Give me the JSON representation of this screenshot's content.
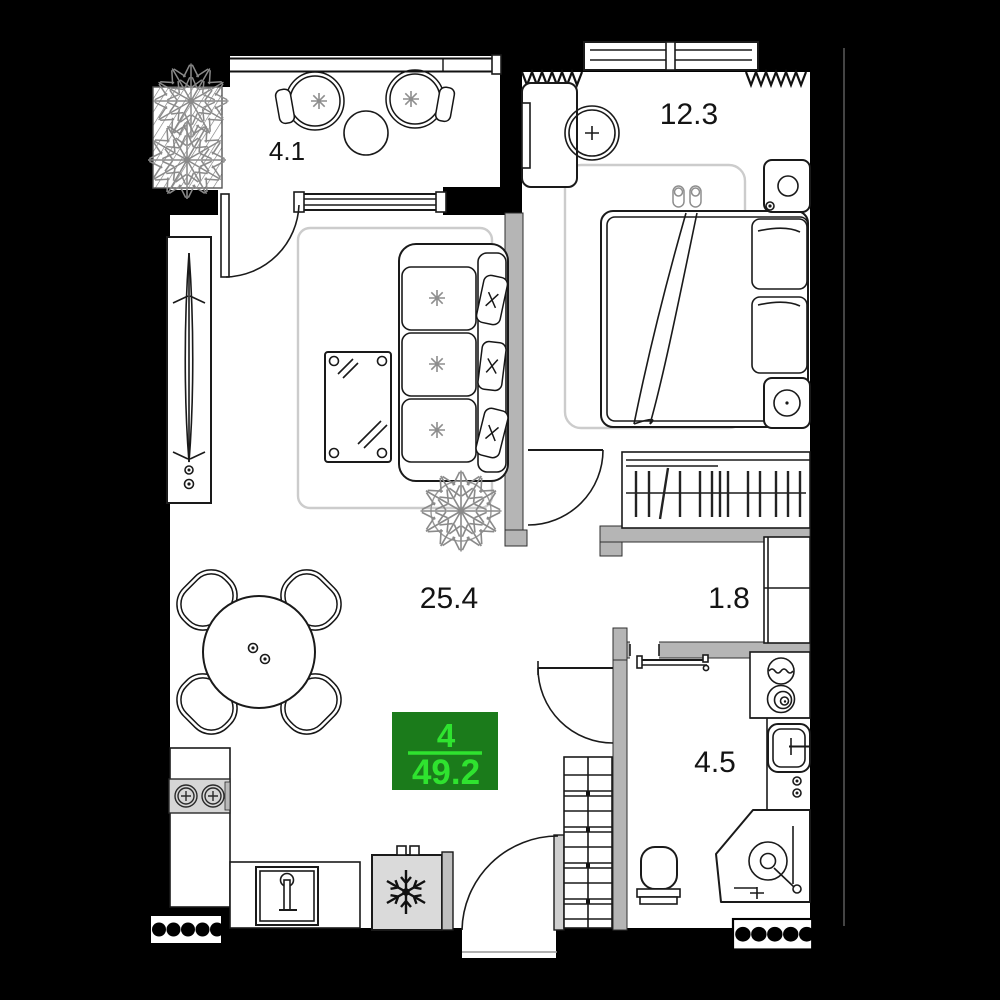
{
  "unit": {
    "number": "4",
    "total_area": "49.2",
    "badge_bg": "#1b7b1b",
    "badge_text_color": "#2fe32f"
  },
  "rooms": {
    "balcony": {
      "label": "4.1"
    },
    "bedroom": {
      "label": "12.3"
    },
    "living_kitchen": {
      "label": "25.4"
    },
    "hallway": {
      "label": "1.8"
    },
    "bathroom": {
      "label": "4.5"
    }
  },
  "palette": {
    "background": "#000000",
    "floor": "#ffffff",
    "partition_wall": "#b5b5b5",
    "line": "#1a1a1a",
    "soft_line": "#8e8e8e"
  },
  "icons": {
    "fridge": "snowflake-icon",
    "washer": "spiral-drum-icon",
    "plant": "plant-icon",
    "vent": "vent-grille-icon"
  }
}
